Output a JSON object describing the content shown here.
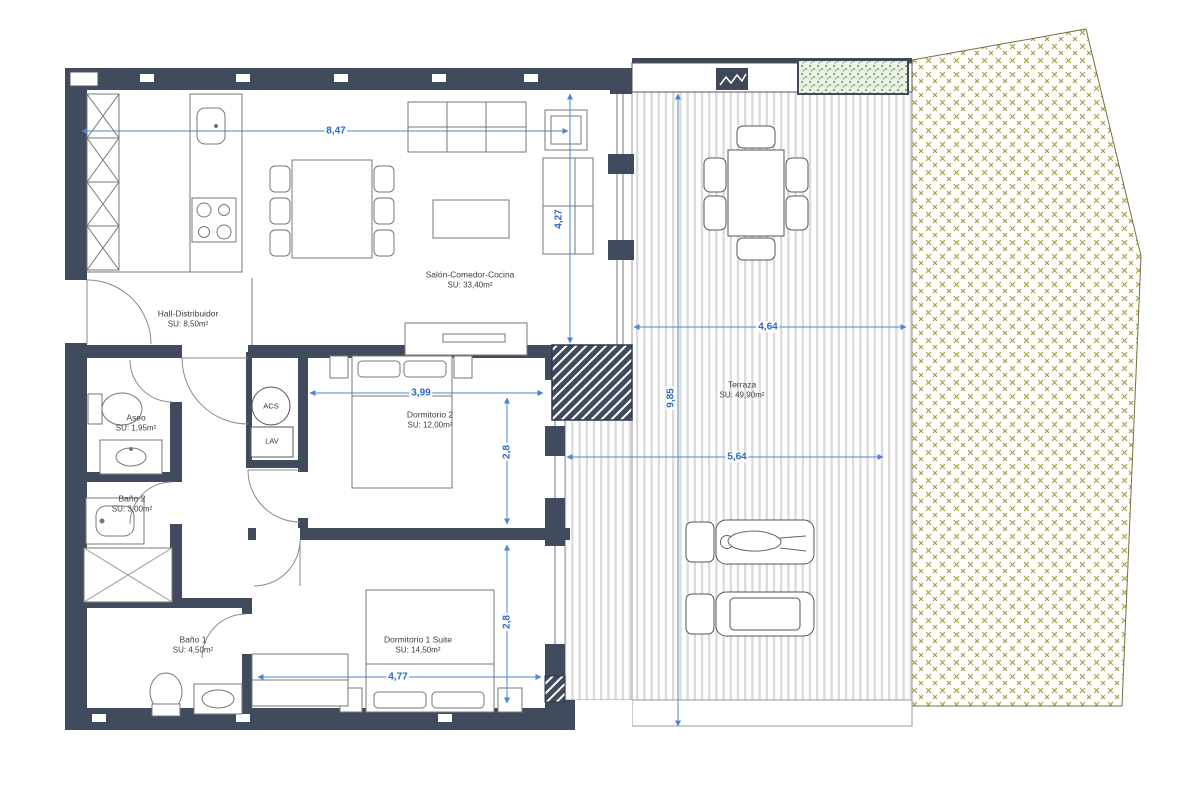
{
  "plan": {
    "rooms": [
      {
        "id": "salon",
        "name": "Salón-Comedor-Cocina",
        "area": "SU: 33,40m²"
      },
      {
        "id": "hall",
        "name": "Hall-Distribuidor",
        "area": "SU: 8,50m²"
      },
      {
        "id": "aseo",
        "name": "Aseo",
        "area": "SU: 1,95m²"
      },
      {
        "id": "bano2",
        "name": "Baño 2",
        "area": "SU: 3,00m²"
      },
      {
        "id": "bano1",
        "name": "Baño 1",
        "area": "SU: 4,50m²"
      },
      {
        "id": "dorm2",
        "name": "Dormitorio 2",
        "area": "SU: 12,00m²"
      },
      {
        "id": "dorm1",
        "name": "Dormitorio 1 Suite",
        "area": "SU: 14,50m²"
      },
      {
        "id": "terraza",
        "name": "Terraza",
        "area": "SU: 49,90m²"
      }
    ],
    "equipment": {
      "acs": "ACS",
      "lav": "LAV"
    },
    "dimensions": {
      "living_width": "8,47",
      "living_depth": "4,27",
      "dorm2_width": "3,99",
      "dorm2_depth": "2,8",
      "dorm1_depth": "2,8",
      "dorm1_width": "4,77",
      "terrace_upper_width": "4,64",
      "terrace_lower_width": "5,64",
      "terrace_depth": "9,85"
    },
    "colors": {
      "wall": "#414b5e",
      "dimension_line": "#4c86d2",
      "dimension_text": "#2d6bc1",
      "deck_stripe": "#dcdcdc",
      "garden_hatch": "#a59b45",
      "planter_green": "#7da36f"
    }
  }
}
